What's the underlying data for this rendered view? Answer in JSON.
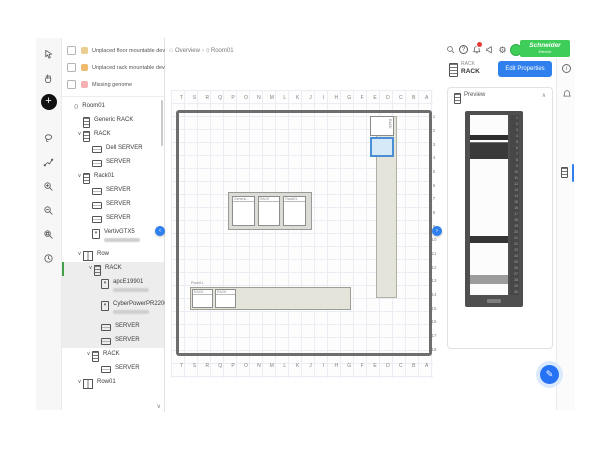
{
  "header": {
    "actions": [
      "search",
      "help",
      "notifications",
      "feedback",
      "settings",
      "account"
    ],
    "notification_badge": true,
    "brand": {
      "line1": "Schneider",
      "line2": "Electric",
      "color": "#3dcd58"
    }
  },
  "breadcrumb": {
    "home": "Overview",
    "current": "Room01"
  },
  "left_toolbar": {
    "tools": [
      "select",
      "pan",
      "add-device",
      "lasso-select",
      "draw-route",
      "zoom-in",
      "zoom-out",
      "zoom-reset",
      "history"
    ]
  },
  "filters": {
    "items": [
      {
        "label": "Unplaced floor mountable devices",
        "icon": "floor-device-icon",
        "icon_color": "#e3bd6a"
      },
      {
        "label": "Unplaced rack mountable devices",
        "icon": "rack-device-icon",
        "icon_color": "#e5a23c"
      },
      {
        "label": "Missing genome",
        "icon": "genome-icon",
        "icon_color": "#ef9a9a"
      }
    ]
  },
  "tree": {
    "items": [
      {
        "level": 0,
        "icon": "room",
        "label": "Room01"
      },
      {
        "level": 1,
        "icon": "rack",
        "label": "Generic RACK"
      },
      {
        "level": 1,
        "icon": "rack",
        "label": "RACK",
        "expanded": true
      },
      {
        "level": 2,
        "icon": "server",
        "label": "Dell SERVER"
      },
      {
        "level": 2,
        "icon": "server",
        "label": "SERVER"
      },
      {
        "level": 1,
        "icon": "rack",
        "label": "Rack01",
        "expanded": true
      },
      {
        "level": 2,
        "icon": "server",
        "label": "SERVER"
      },
      {
        "level": 2,
        "icon": "server",
        "label": "SERVER"
      },
      {
        "level": 2,
        "icon": "server",
        "label": "SERVER"
      },
      {
        "level": 2,
        "icon": "device",
        "label": "VertivGTX5",
        "subtitle_redacted": true
      },
      {
        "level": 1,
        "icon": "row",
        "label": "Row",
        "expanded": true
      },
      {
        "level": 2,
        "icon": "rack",
        "label": "RACK",
        "expanded": true,
        "selected": true,
        "selected_bar": true
      },
      {
        "level": 3,
        "icon": "device",
        "label": "apcE19901",
        "subtitle_redacted": true,
        "selected": true
      },
      {
        "level": 3,
        "icon": "device",
        "label": "CyberPowerPR2200R...",
        "subtitle_redacted": true,
        "selected": true
      },
      {
        "level": 3,
        "icon": "server",
        "label": "SERVER",
        "selected": true
      },
      {
        "level": 3,
        "icon": "server",
        "label": "SERVER",
        "selected": true
      },
      {
        "level": 2,
        "icon": "rack",
        "label": "RACK",
        "expanded": true
      },
      {
        "level": 3,
        "icon": "server",
        "label": "SERVER"
      },
      {
        "level": 1,
        "icon": "row",
        "label": "Row01",
        "expanded": true
      }
    ]
  },
  "canvas": {
    "column_letters": [
      "T",
      "S",
      "R",
      "Q",
      "P",
      "O",
      "N",
      "M",
      "L",
      "K",
      "J",
      "I",
      "H",
      "G",
      "F",
      "E",
      "D",
      "C",
      "B",
      "A"
    ],
    "row_count": 18,
    "objects": {
      "row_vertical": {
        "cells": [
          {
            "label": "RACK",
            "selected": false
          },
          {
            "label": "",
            "selected": true
          }
        ]
      },
      "rack_group": {
        "cells": [
          "Generic...",
          "RACK",
          "Rack01"
        ]
      },
      "row_horizontal": {
        "label": "Row01",
        "cells": [
          "RACK",
          "RACK"
        ]
      }
    }
  },
  "inspector": {
    "type": "RACK",
    "title": "RACK",
    "edit_button": "Edit Properties",
    "preview": {
      "label": "Preview",
      "u_ticks": 30,
      "devices": [
        {
          "name": "server-unit",
          "top_pct": 11,
          "height_pct": 3,
          "color": "#2e2e2e"
        },
        {
          "name": "ups-unit",
          "top_pct": 15,
          "height_pct": 9,
          "color": "#3a3a3a",
          "striped": true
        },
        {
          "name": "server-unit",
          "top_pct": 67,
          "height_pct": 4,
          "color": "#353535"
        },
        {
          "name": "shelf-unit",
          "top_pct": 89,
          "height_pct": 5,
          "color": "#9c9c9c"
        }
      ]
    }
  },
  "right_rail": {
    "icons": [
      "info",
      "alarms",
      "rack-preview"
    ],
    "active": "rack-preview"
  },
  "icons": {
    "home": "⌂",
    "room": "⟨⟩",
    "breadcrumb_separator": "›",
    "chevron_expanded": "∨",
    "collapse_up": "∧",
    "panel_left": "‹",
    "panel_right": "›",
    "plus": "+",
    "gear": "⚙",
    "pencil": "✎",
    "question": "?",
    "info": "i"
  },
  "colors": {
    "accent_blue": "#2f80ed",
    "selection_fill": "#d6e9f8",
    "selection_border": "#4a8fd3",
    "row_fill": "#e4e4da",
    "brand_green": "#3dcd58",
    "selected_tree_bar": "#43a047",
    "badge_red": "#e53935"
  }
}
